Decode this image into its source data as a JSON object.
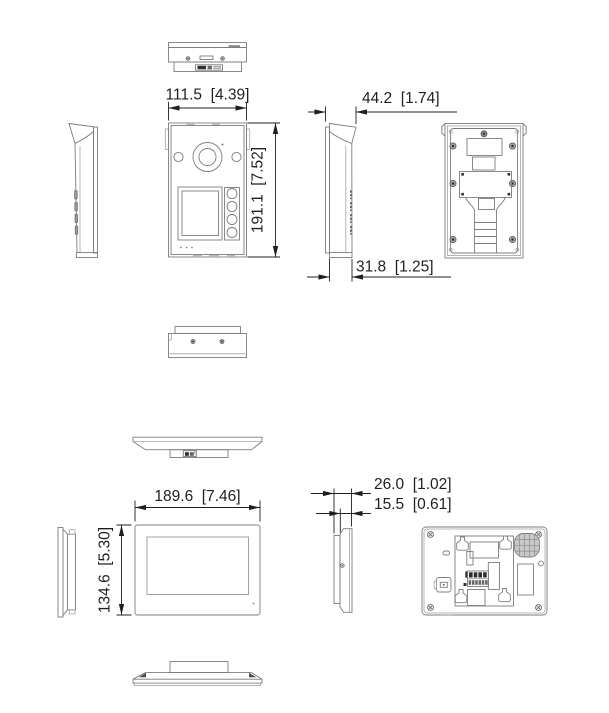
{
  "door_station": {
    "width_label": "111.5  [4.39]",
    "height_label": "191.1  [7.52]",
    "depth_with_hood_label": "44.2  [1.74]",
    "depth_body_label": "31.8  [1.25]"
  },
  "indoor_monitor": {
    "width_label": "189.6  [7.46]",
    "height_label": "134.6  [5.30]",
    "depth_with_bracket_label": "26.0  [1.02]",
    "depth_body_label": "15.5  [0.61]"
  },
  "style": {
    "background": "#ffffff",
    "line_color": "#7d7d7d",
    "dimension_color": "#1f1f1f"
  }
}
